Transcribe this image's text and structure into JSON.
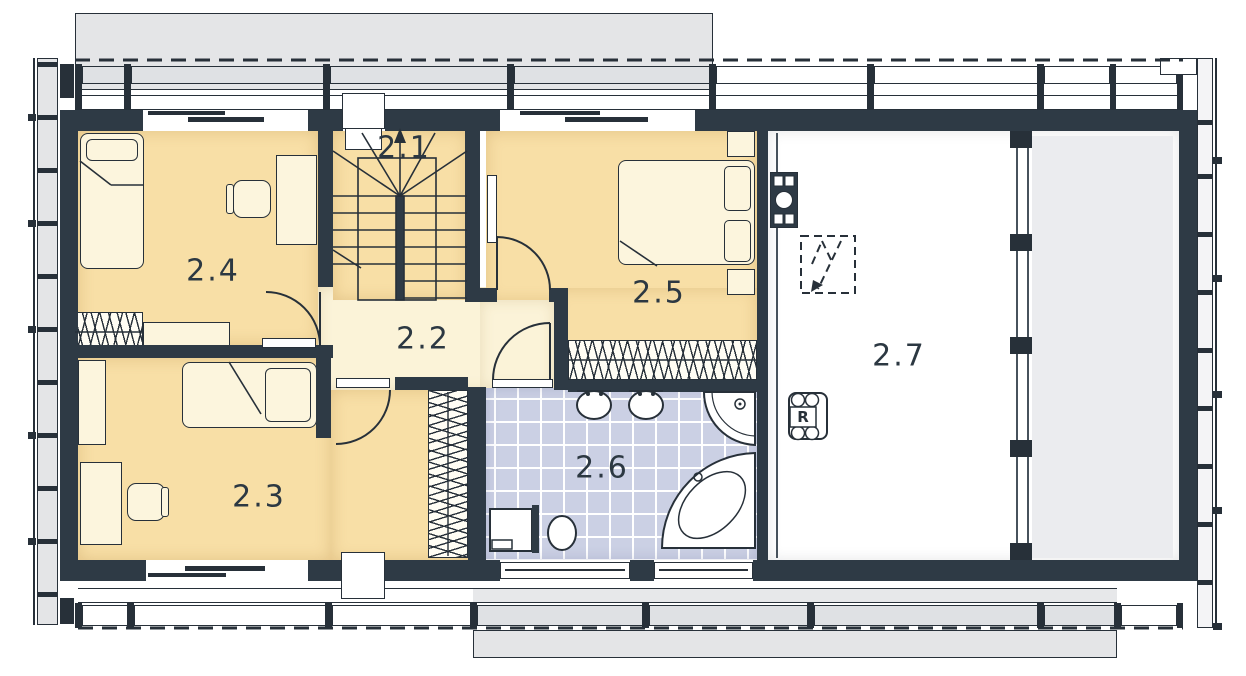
{
  "plan": {
    "rooms": [
      {
        "id": "2.1",
        "kind": "staircase"
      },
      {
        "id": "2.2",
        "kind": "hall"
      },
      {
        "id": "2.3",
        "kind": "bedroom"
      },
      {
        "id": "2.4",
        "kind": "bedroom"
      },
      {
        "id": "2.5",
        "kind": "bedroom"
      },
      {
        "id": "2.6",
        "kind": "bathroom"
      },
      {
        "id": "2.7",
        "kind": "attic-space"
      }
    ],
    "symbols": {
      "recuperator_label": "R"
    }
  },
  "colors": {
    "ink": "#273039",
    "wall": "#2e3a45",
    "peach": "#f8dfa6",
    "cream": "#fbf3d8",
    "tile": "#cbd0e4",
    "roofgray": "#e4e5e7",
    "panelgray": "#dfe1e4",
    "areagray": "#ebecef",
    "furn": "#fcf5dd",
    "hatchbg": "#fffdf4",
    "label": "#2c3842"
  }
}
